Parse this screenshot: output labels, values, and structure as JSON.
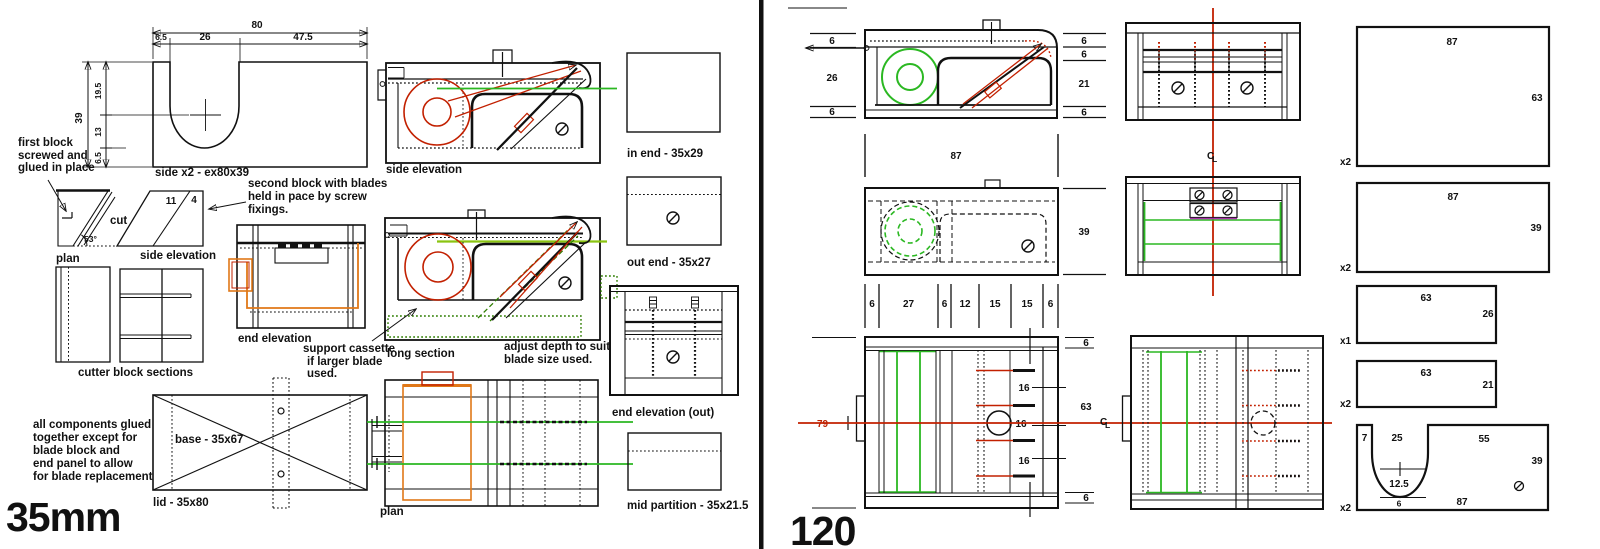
{
  "titles": {
    "left": "35mm",
    "right": "120"
  },
  "left": {
    "side_block": {
      "caption": "side x2 - ex80x39",
      "dims": {
        "overall_w": "80",
        "w1": "6.5",
        "w2": "26",
        "w3": "47.5",
        "overall_h": "39",
        "h1": "19.5",
        "h2": "13",
        "h3": "6.5"
      }
    },
    "notes": {
      "first_block": [
        "first block",
        "screwed and",
        "glued in place"
      ],
      "second_block": [
        "second block with blades",
        "held in pace by screw",
        "fixings."
      ],
      "support_cassette": [
        "support cassette",
        "if larger blade",
        "used."
      ],
      "adjust_depth": [
        "adjust depth to suit",
        "blade size used."
      ],
      "glued": [
        "all components glued",
        "together except for",
        "blade block and",
        "end panel to allow",
        "for blade replacement"
      ]
    },
    "cut_block": {
      "plan": "plan",
      "cut": "cut",
      "angle": "53°"
    },
    "blade_block": {
      "label": "side elevation",
      "n1": "11",
      "n2": "4"
    },
    "cutter_sections": "cutter block sections",
    "labels": {
      "side_elevation": "side elevation",
      "long_section": "long section",
      "end_elevation": "end elevation",
      "plan": "plan",
      "in_end": "in end - 35x29",
      "out_end": "out end - 35x27",
      "end_elevation_out": "end elevation (out)",
      "mid_partition": "mid partition - 35x21.5",
      "base": "base - 35x67",
      "lid": "lid - 35x80"
    }
  },
  "right": {
    "dims": {
      "d6": "6",
      "d12": "12",
      "d15": "15",
      "d16": "16",
      "d21": "21",
      "d26": "26",
      "d27": "27",
      "d39": "39",
      "d63": "63",
      "d79": "79",
      "d87": "87"
    },
    "centerline": {
      "c": "C",
      "l": "L"
    },
    "parts": [
      {
        "w": "87",
        "h": "63",
        "qty": "x2"
      },
      {
        "w": "87",
        "h": "39",
        "qty": "x2"
      },
      {
        "w": "63",
        "h": "26",
        "qty": "x1"
      },
      {
        "w": "63",
        "h": "21",
        "qty": "x2"
      },
      {
        "top1": "7",
        "top2": "25",
        "top3": "55",
        "u_w": "12.5",
        "u_b": "6",
        "w": "87",
        "h": "39",
        "qty": "x2"
      }
    ]
  }
}
